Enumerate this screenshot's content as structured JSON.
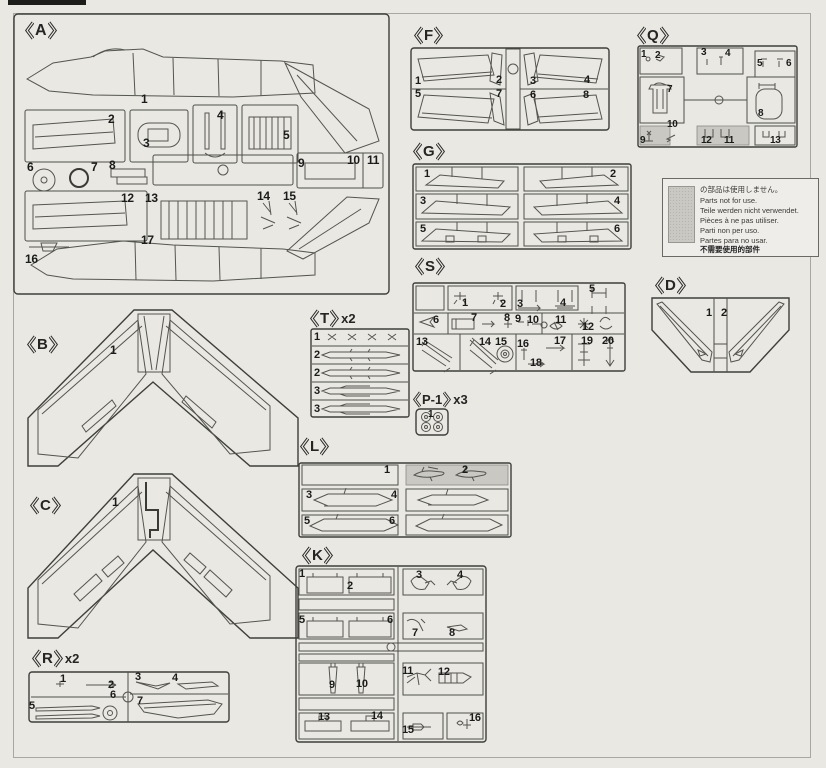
{
  "page": {
    "background": "#e9e8e3",
    "ink": "#3e3e3b",
    "shade_color": "#c9c8c3"
  },
  "note_box": {
    "lines": [
      "の部品は使用しません。",
      "Parts not for use.",
      "Teile werden nicht verwendet.",
      "Pièces à ne pas utiliser.",
      "Parti non per uso.",
      "Partes para no usar.",
      "不需要使用的部件"
    ]
  },
  "sprues": {
    "A": {
      "letter": "A",
      "parts": [
        "1",
        "2",
        "3",
        "4",
        "5",
        "6",
        "7",
        "8",
        "9",
        "10",
        "11",
        "12",
        "13",
        "14",
        "15",
        "16",
        "17"
      ]
    },
    "B": {
      "letter": "B",
      "parts": [
        "1"
      ]
    },
    "C": {
      "letter": "C",
      "parts": [
        "1"
      ]
    },
    "D": {
      "letter": "D",
      "parts": [
        "1",
        "2"
      ]
    },
    "F": {
      "letter": "F",
      "parts": [
        "1",
        "2",
        "3",
        "4",
        "5",
        "7",
        "6",
        "8"
      ]
    },
    "G": {
      "letter": "G",
      "parts": [
        "1",
        "2",
        "3",
        "4",
        "5",
        "6"
      ]
    },
    "K": {
      "letter": "K",
      "parts": [
        "1",
        "2",
        "3",
        "4",
        "5",
        "6",
        "7",
        "8",
        "9",
        "10",
        "11",
        "12",
        "13",
        "14",
        "15",
        "16"
      ]
    },
    "L": {
      "letter": "L",
      "parts": [
        "1",
        "2",
        "3",
        "4",
        "5",
        "6"
      ]
    },
    "P1": {
      "letter": "P-1",
      "qty": "x3",
      "parts": [
        "1"
      ]
    },
    "Q": {
      "letter": "Q",
      "parts": [
        "1",
        "2",
        "3",
        "4",
        "5",
        "6",
        "7",
        "8",
        "9",
        "10",
        "12",
        "11",
        "13"
      ]
    },
    "R": {
      "letter": "R",
      "qty": "x2",
      "parts": [
        "1",
        "2",
        "3",
        "4",
        "5",
        "6",
        "7"
      ]
    },
    "S": {
      "letter": "S",
      "parts": [
        "1",
        "2",
        "3",
        "4",
        "5",
        "6",
        "7",
        "8",
        "9",
        "10",
        "11",
        "12",
        "13",
        "14",
        "15",
        "16",
        "17",
        "19",
        "20",
        "18"
      ]
    },
    "T": {
      "letter": "T",
      "qty": "x2",
      "parts": [
        "1",
        "2",
        "2",
        "3",
        "3"
      ]
    }
  }
}
